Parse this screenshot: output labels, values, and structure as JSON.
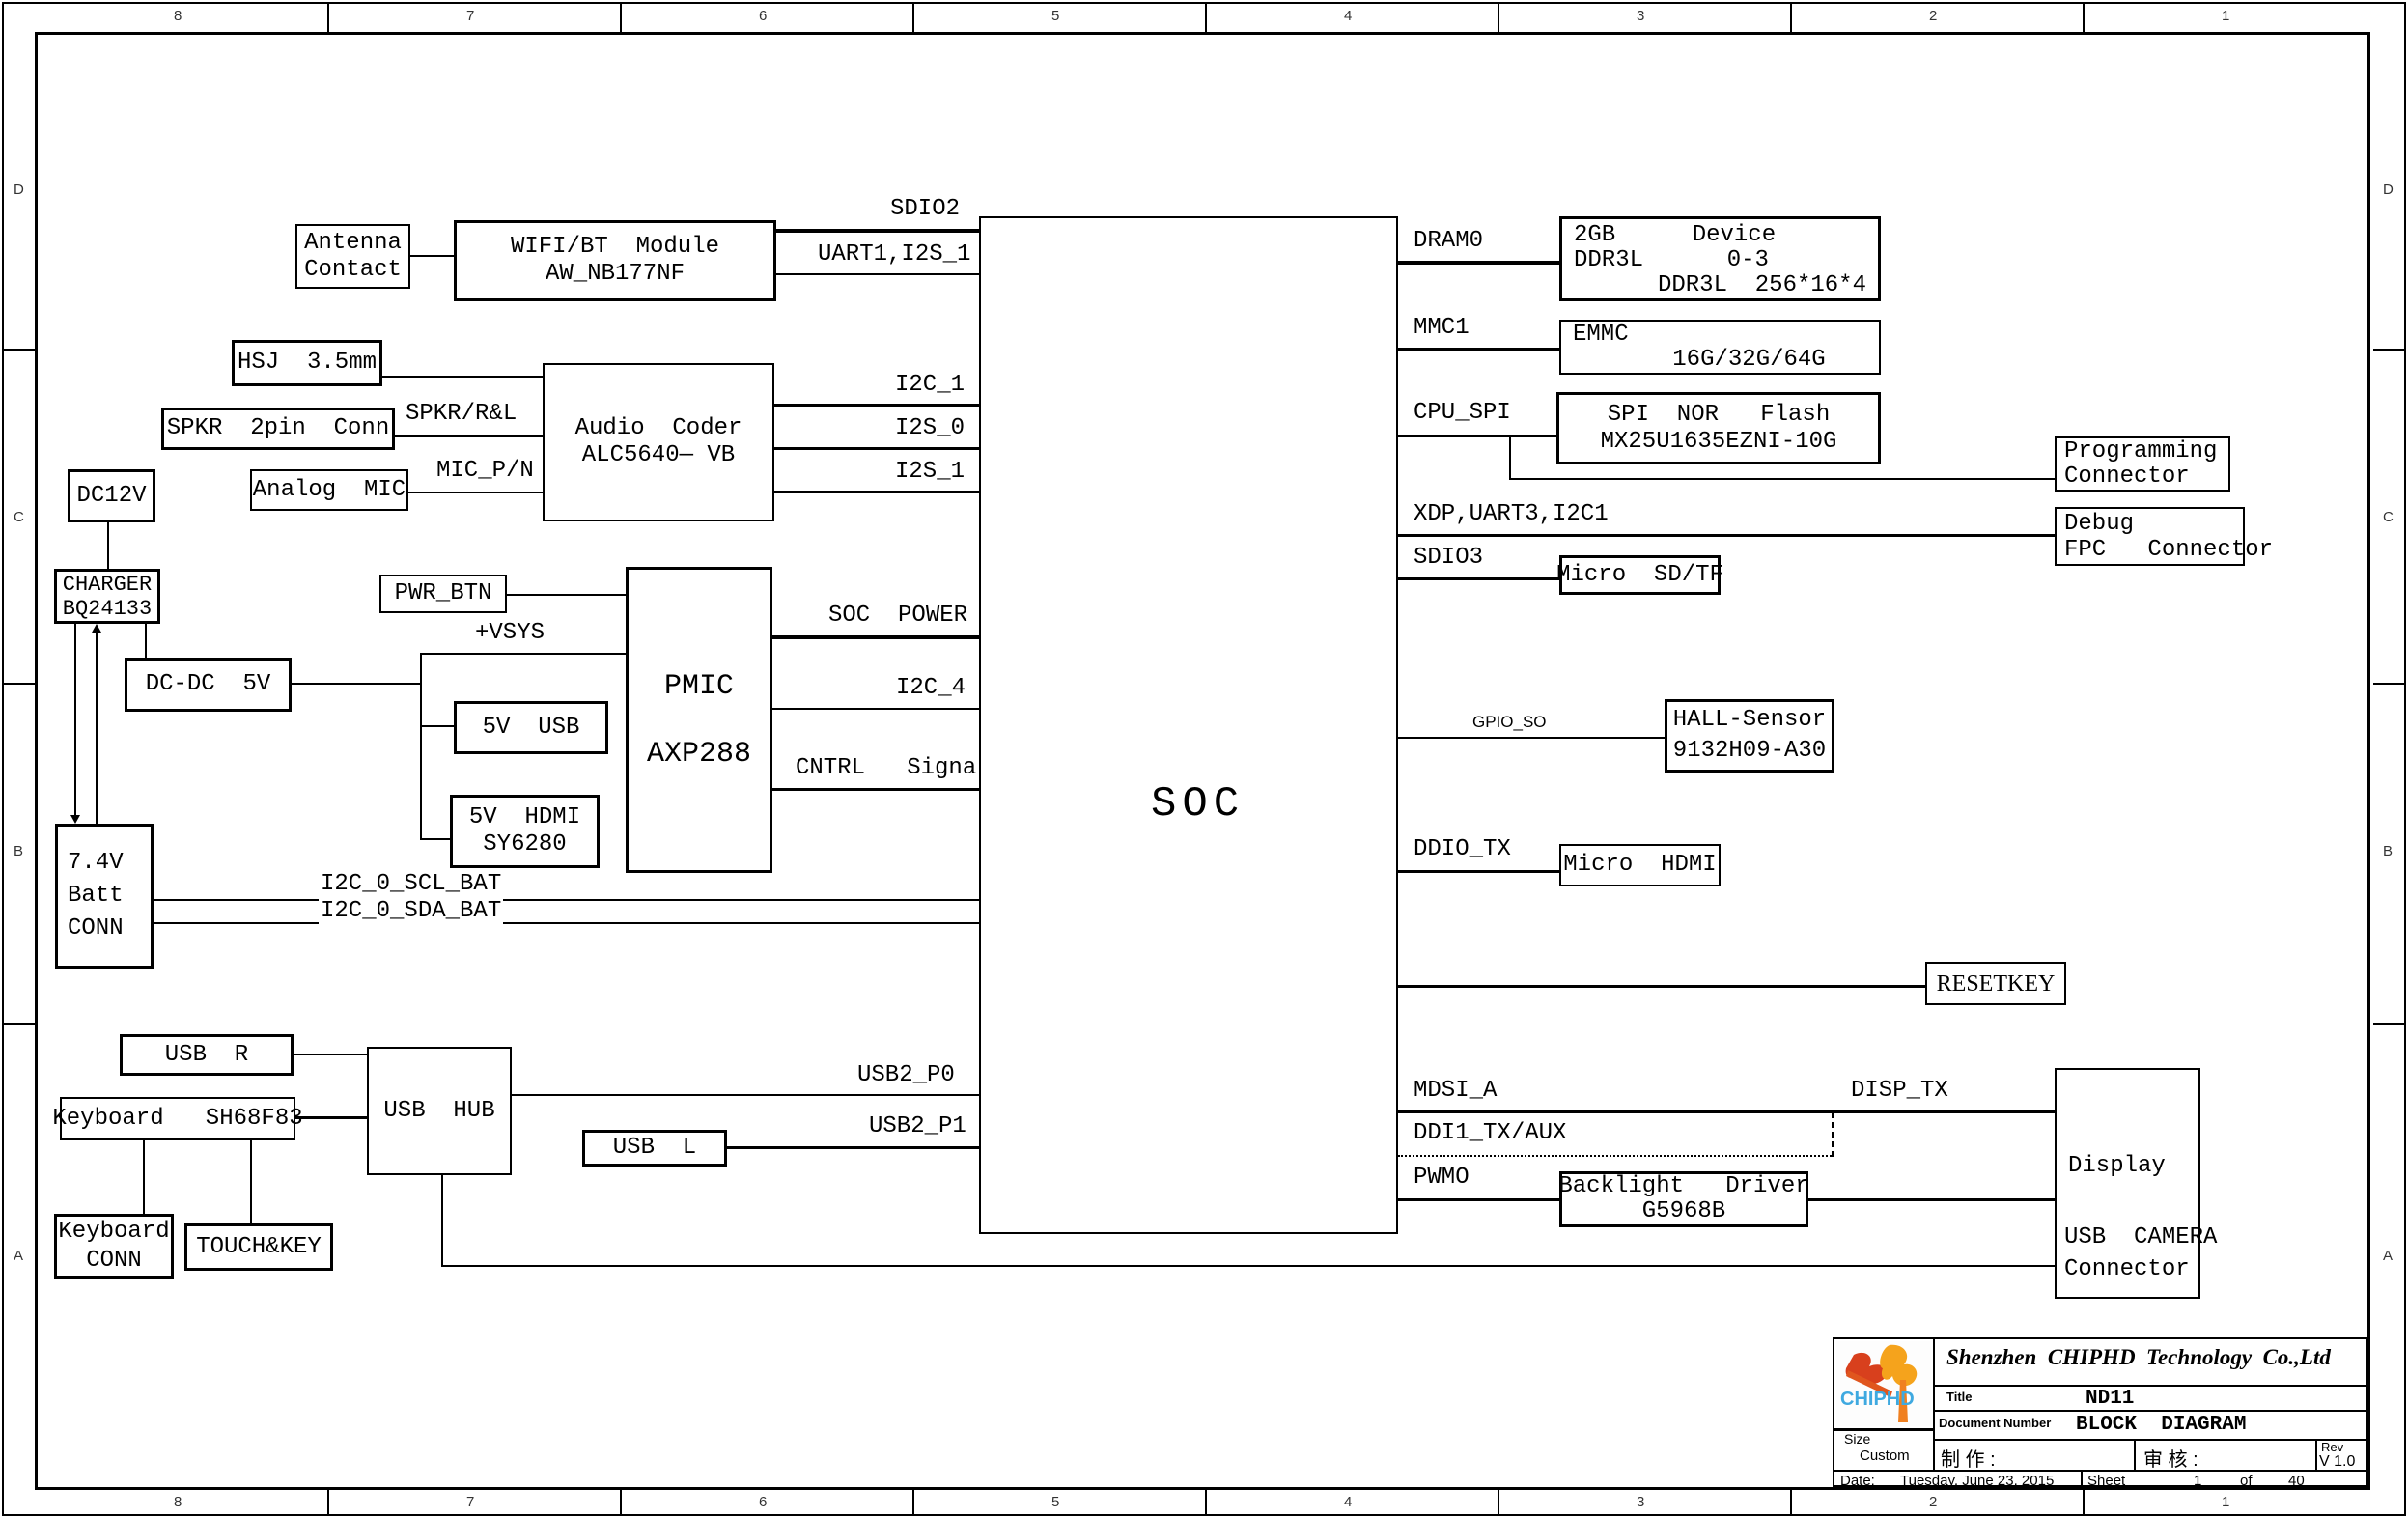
{
  "sheet": {
    "zone_cols": [
      "8",
      "7",
      "6",
      "5",
      "4",
      "3",
      "2",
      "1"
    ],
    "zone_rows": [
      "D",
      "C",
      "B",
      "A"
    ]
  },
  "blocks": {
    "antenna": {
      "l1": "Antenna",
      "l2": "Contact"
    },
    "wifi": {
      "l1": "WIFI/BT  Module",
      "l2": "AW_NB177NF"
    },
    "hsj": {
      "l1": "HSJ  3.5mm"
    },
    "spkr": {
      "l1": "SPKR  2pin  Conn"
    },
    "analog_mic": {
      "l1": "Analog  MIC"
    },
    "audio": {
      "l1": "Audio  Coder",
      "l2": "ALC5640— VB"
    },
    "dc12v": {
      "l1": "DC12V"
    },
    "charger": {
      "l1": "CHARGER",
      "l2": "BQ24133"
    },
    "pwr_btn": {
      "l1": "PWR_BTN"
    },
    "dcdc": {
      "l1": "DC-DC  5V"
    },
    "pmic": {
      "l1": "PMIC",
      "l2": "AXP288"
    },
    "usb5v": {
      "l1": "5V  USB"
    },
    "hdmi5v": {
      "l1": "5V  HDMI",
      "l2": "SY6280"
    },
    "batt": {
      "l1": "7.4V",
      "l2": "Batt",
      "l3": "CONN"
    },
    "usb_r": {
      "l1": "USB  R"
    },
    "kb": {
      "l1": "Keyboard   SH68F83"
    },
    "usb_hub": {
      "l1": "USB  HUB"
    },
    "usb_l": {
      "l1": "USB  L"
    },
    "kb_conn": {
      "l1": "Keyboard",
      "l2": "CONN"
    },
    "touchkey": {
      "l1": "TOUCH&KEY"
    },
    "soc": {
      "l1": "SOC"
    },
    "dram": {
      "l1a": "2GB",
      "l1b": "Device",
      "l2a": "DDR3L",
      "l2b": "0-3",
      "l3": "DDR3L  256*16*4"
    },
    "emmc": {
      "l1": "EMMC",
      "l2": "16G/32G/64G"
    },
    "spi": {
      "l1": "SPI  NOR   Flash",
      "l2": "MX25U1635EZNI-10G"
    },
    "prog": {
      "l1": "Programming",
      "l2": "Connector"
    },
    "debug": {
      "l1": "Debug",
      "l2": "FPC   Connector"
    },
    "microsd": {
      "l1": "Micro  SD/TF"
    },
    "hall": {
      "l1": "HALL-Sensor",
      "l2": "9132H09-A30"
    },
    "microhdmi": {
      "l1": "Micro  HDMI"
    },
    "resetkey": {
      "l1": "RESETKEY"
    },
    "backlight": {
      "l1": "Backlight   Driver",
      "l2": "G5968B"
    },
    "display": {
      "l1": "Display",
      "l2": "USB  CAMERA",
      "l3": "Connector"
    }
  },
  "nets": {
    "sdio2": "SDIO2",
    "uart1": "UART1,I2S_1",
    "i2c_1": "I2C_1",
    "i2s_0": "I2S_0",
    "i2s_1": "I2S_1",
    "spkr_rl": "SPKR/R&L",
    "mic_pn": "MIC_P/N",
    "vsys": "+VSYS",
    "soc_power": "SOC  POWER",
    "i2c_4": "I2C_4",
    "cntrl": "CNTRL   Signals",
    "i2c0_scl": "I2C_0_SCL_BAT",
    "i2c0_sda": "I2C_0_SDA_BAT",
    "usb2_p0": "USB2_P0",
    "usb2_p1": "USB2_P1",
    "dram0": "DRAM0",
    "mmc1": "MMC1",
    "cpu_spi": "CPU_SPI",
    "xdp": "XDP,UART3,I2C1",
    "sdio3": "SDIO3",
    "gpio_so": "GPIO_SO",
    "ddio_tx": "DDIO_TX",
    "mdsi_a": "MDSI_A",
    "disp_tx": "DISP_TX",
    "ddi1": "DDI1_TX/AUX",
    "pwmo": "PWMO"
  },
  "titleblock": {
    "company": "Shenzhen  CHIPHD  Technology  Co.,Ltd",
    "title_label": "Title",
    "title": "ND11",
    "doc_label": "Document  Number",
    "doc": "BLOCK  DIAGRAM",
    "size_label": "Size",
    "size": "Custom",
    "made_label": "制 作 :",
    "review_label": "审 核 :",
    "rev_label": "Rev",
    "rev": "V 1.0",
    "date_label": "Date:",
    "date": "Tuesday, June 23, 2015",
    "sheet_label": "Sheet",
    "sheet_no": "1",
    "of_label": "of",
    "sheet_total": "40",
    "logo_text": "CHIPHD",
    "logo_colors": {
      "orange": "#f5a31c",
      "red": "#d8401d",
      "blue": "#3fa9e0"
    }
  }
}
